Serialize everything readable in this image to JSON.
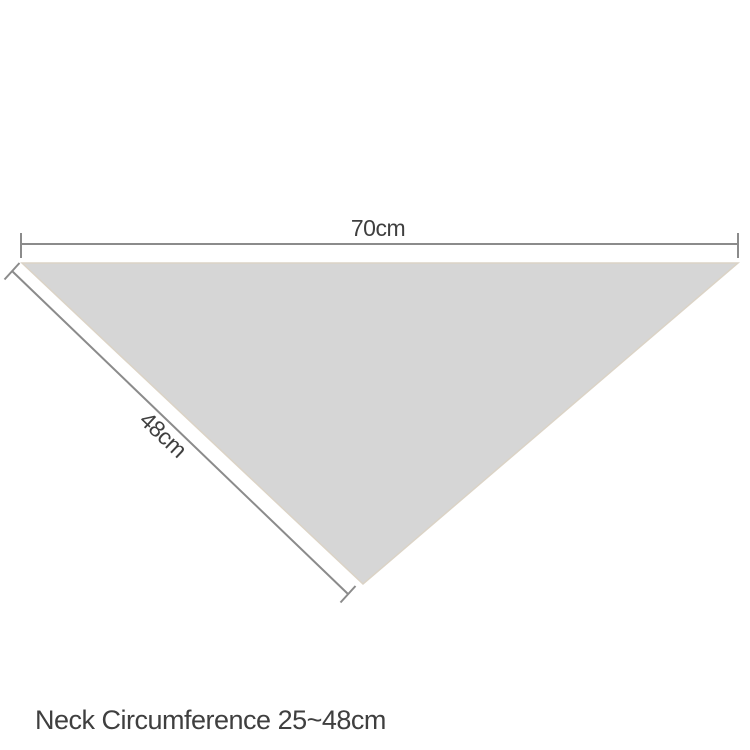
{
  "diagram": {
    "fabric_fill_color": "#d6d6d6",
    "fabric_edge_color": "#dbd3c6",
    "dimension_line_color": "#8b8b8b",
    "label_color": "#3f3f3f",
    "top_dimension_label": "70cm",
    "side_dimension_label": "48cm"
  },
  "caption": {
    "text": "Neck Circumference 25~48cm"
  }
}
